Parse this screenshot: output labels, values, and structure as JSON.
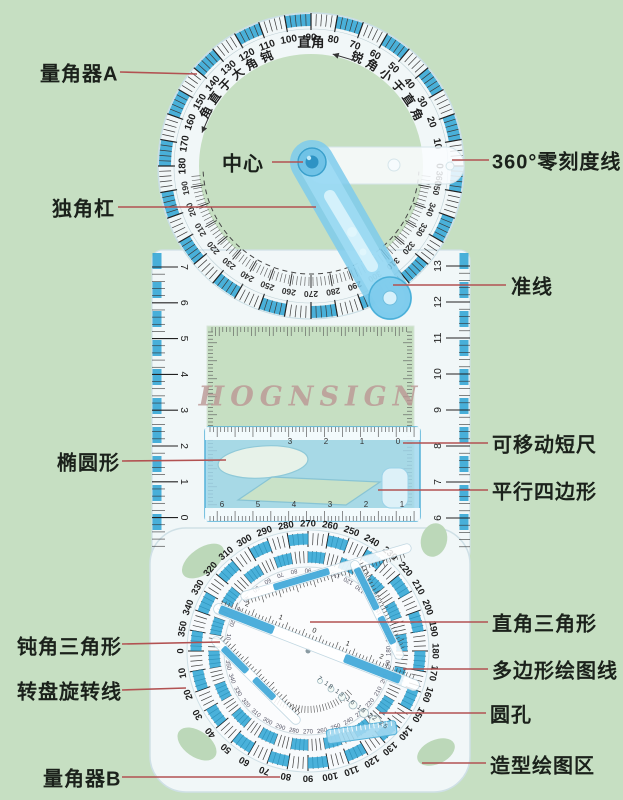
{
  "watermark": "HOGNSIGN",
  "colors": {
    "background": "#c6dfc2",
    "leader_line": "#b25252",
    "label_text": "#1b211b",
    "tick_blue": "#2ba3d4",
    "arm_blue": "#7dcbec",
    "short_ruler_blue": "#9fd7ef"
  },
  "labels": {
    "protractor_a": "量角器A",
    "center": "中心",
    "zero_line": "360°零刻度线",
    "single_bar": "独角杠",
    "guide_line": "准线",
    "ellipse": "椭圆形",
    "movable_ruler": "可移动短尺",
    "parallelogram": "平行四边形",
    "obtuse_triangle": "钝角三角形",
    "right_triangle": "直角三角形",
    "polygon_lines": "多边形绘图线",
    "rotary_line": "转盘旋转线",
    "round_holes": "圆孔",
    "protractor_b": "量角器B",
    "drawing_area": "造型绘图区"
  },
  "top_protractor": {
    "right_angle": "直角",
    "obtuse_text": "钝角大于直角",
    "acute_text": "锐角小于直角",
    "zero_alias": "360",
    "outer_numbers": [
      0,
      10,
      20,
      30,
      40,
      50,
      60,
      70,
      80,
      90,
      100,
      110,
      120,
      130,
      140,
      150,
      160,
      170,
      180
    ],
    "inner_numbers": [
      190,
      200,
      210,
      220,
      230,
      240,
      250,
      260,
      270,
      280,
      290,
      300,
      310,
      320,
      330,
      340,
      350
    ]
  },
  "bottom_dial": {
    "outer_numbers": [
      0,
      10,
      20,
      30,
      40,
      50,
      60,
      70,
      80,
      90,
      100,
      110,
      120,
      130,
      140,
      150,
      160,
      170,
      180,
      190,
      200,
      210,
      220,
      230,
      240,
      250,
      260,
      270,
      280,
      290,
      300,
      310,
      320,
      330,
      340,
      350
    ],
    "hole_numbers": "7 18 13 16 18 22 25",
    "bar_numbers": [
      "2",
      "1",
      "0",
      "1",
      "2"
    ]
  },
  "rulers": {
    "mid_left": [
      "7",
      "6",
      "5",
      "4",
      "3",
      "2",
      "1",
      "0"
    ],
    "mid_right": [
      "13",
      "12",
      "11",
      "10",
      "9",
      "8",
      "7",
      "6"
    ],
    "bottom_right": [
      "5",
      "4",
      "3",
      "2",
      "1",
      "0"
    ],
    "short_top": [
      "3",
      "2",
      "1",
      "0"
    ],
    "short_bottom": [
      "6",
      "5",
      "4",
      "3",
      "2",
      "1"
    ]
  }
}
